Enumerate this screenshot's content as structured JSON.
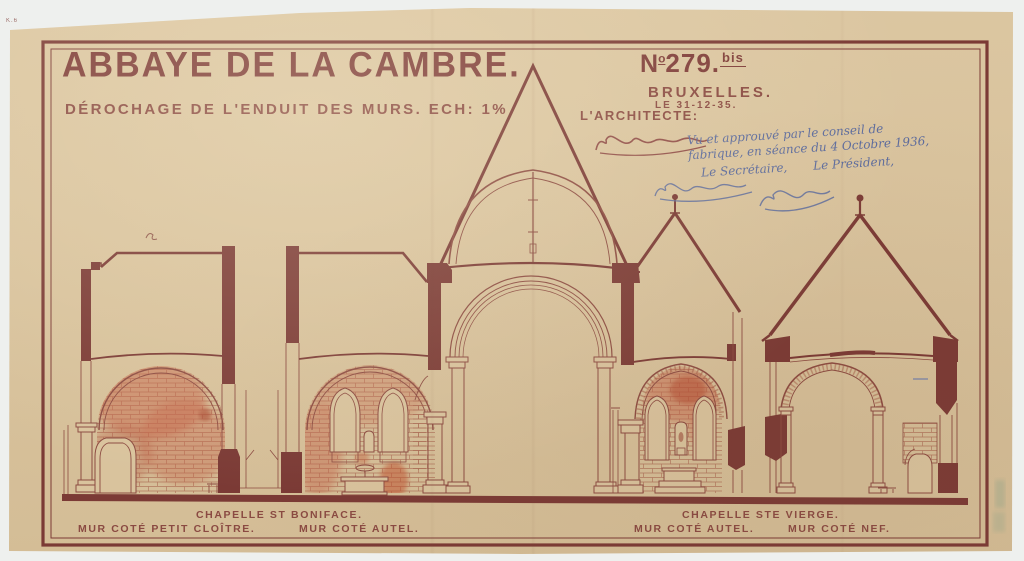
{
  "page": {
    "corner_mark": "K.6",
    "colors": {
      "paper": "#d9c39d",
      "ink": "#7b3a35",
      "wash_red": "#c4654a",
      "blue_ink": "#5c6b9d",
      "stamp_green": "#6f9c86"
    }
  },
  "title_block": {
    "title": "ABBAYE DE LA CAMBRE.",
    "subtitle": "DÉROCHAGE DE L'ENDUIT DES MURS. ECH: 1%",
    "number_prefix": "N",
    "number_sup": "o",
    "number": "279.",
    "number_suffix": "bis",
    "city": "BRUXELLES.",
    "date_line": "LE 31-12-35.",
    "architect_label": "L'ARCHITECTE:"
  },
  "approval_note": {
    "line1": "Vu et approuvé par le conseil de",
    "line2": "fabrique, en séance du 4 Octobre 1936,",
    "secretary": "Le Secrétaire,",
    "president": "Le Président,"
  },
  "captions": {
    "left_group_title": "CHAPELLE ST BONIFACE.",
    "left_caption_1": "MUR COTÉ PETIT CLOÎTRE.",
    "left_caption_2": "MUR COTÉ AUTEL.",
    "right_group_title": "CHAPELLE STE VIERGE.",
    "right_caption_1": "MUR COTÉ AUTEL.",
    "right_caption_2": "MUR COTÉ NEF."
  }
}
